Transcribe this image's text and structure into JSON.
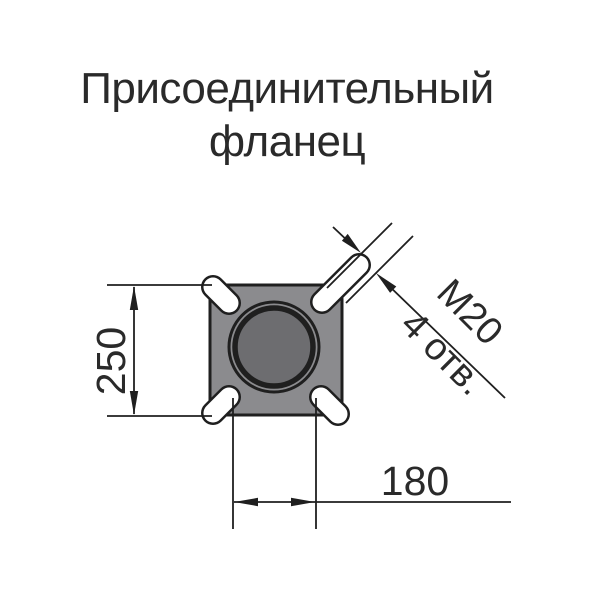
{
  "title": {
    "line1": "Присоединительный",
    "line2": "фланец"
  },
  "drawing": {
    "type": "technical-dimension-drawing",
    "part": "flange top view with square body, corner bolt slots and central bore",
    "dimensions": {
      "height_label": "250",
      "spacing_label": "180",
      "thread_label": "M20",
      "holes_label": "4 отв."
    },
    "colors": {
      "flange_fill": "#8b8b8e",
      "bore_fill": "#6d6d70",
      "outline": "#1f1f1f",
      "text": "#2a2a2a",
      "background": "#ffffff"
    }
  }
}
